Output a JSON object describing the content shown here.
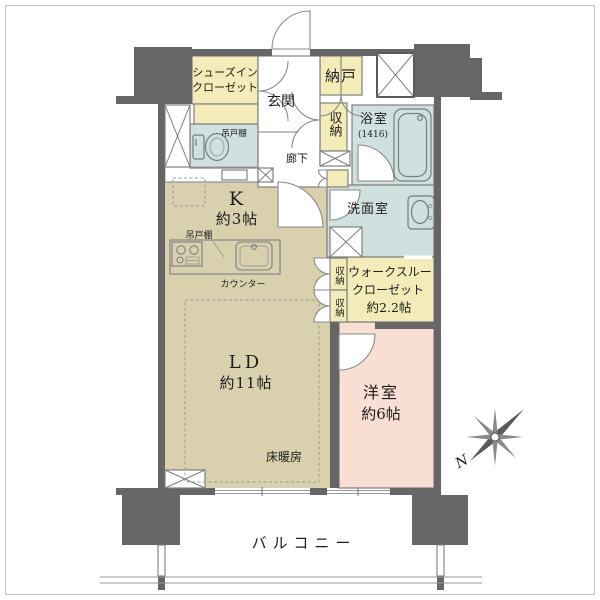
{
  "floorplan": {
    "labels": {
      "shoes_closet_line1": "シューズイン",
      "shoes_closet_line2": "クローゼット",
      "entrance": "玄関",
      "storeroom": "納戸",
      "hall_closet": "収納",
      "bathroom": "浴室",
      "bathroom_size": "(1416)",
      "toilet_cupboard": "吊戸棚",
      "corridor": "廊下",
      "kitchen": "K",
      "kitchen_size": "約3帖",
      "kitchen_cupboard": "吊戸棚",
      "kitchen_counter": "カウンター",
      "washroom": "洗面室",
      "closet_upper": "収納",
      "closet_lower": "収納",
      "walkthrough_line1": "ウォークスルー",
      "walkthrough_line2": "クローゼット",
      "walkthrough_line3": "約2.2帖",
      "living_dining": "LD",
      "living_dining_size": "約11帖",
      "floor_heating": "床暖房",
      "western_room": "洋室",
      "western_room_size": "約6帖",
      "balcony": "バルコニー",
      "compass_north": "N"
    },
    "colors": {
      "wall": "#666666",
      "closet_yellow": "#f3ecb8",
      "wet_area_blue": "#cfe0df",
      "living_tan": "#d9d0ae",
      "bedroom_pink": "#f9ded3"
    }
  }
}
